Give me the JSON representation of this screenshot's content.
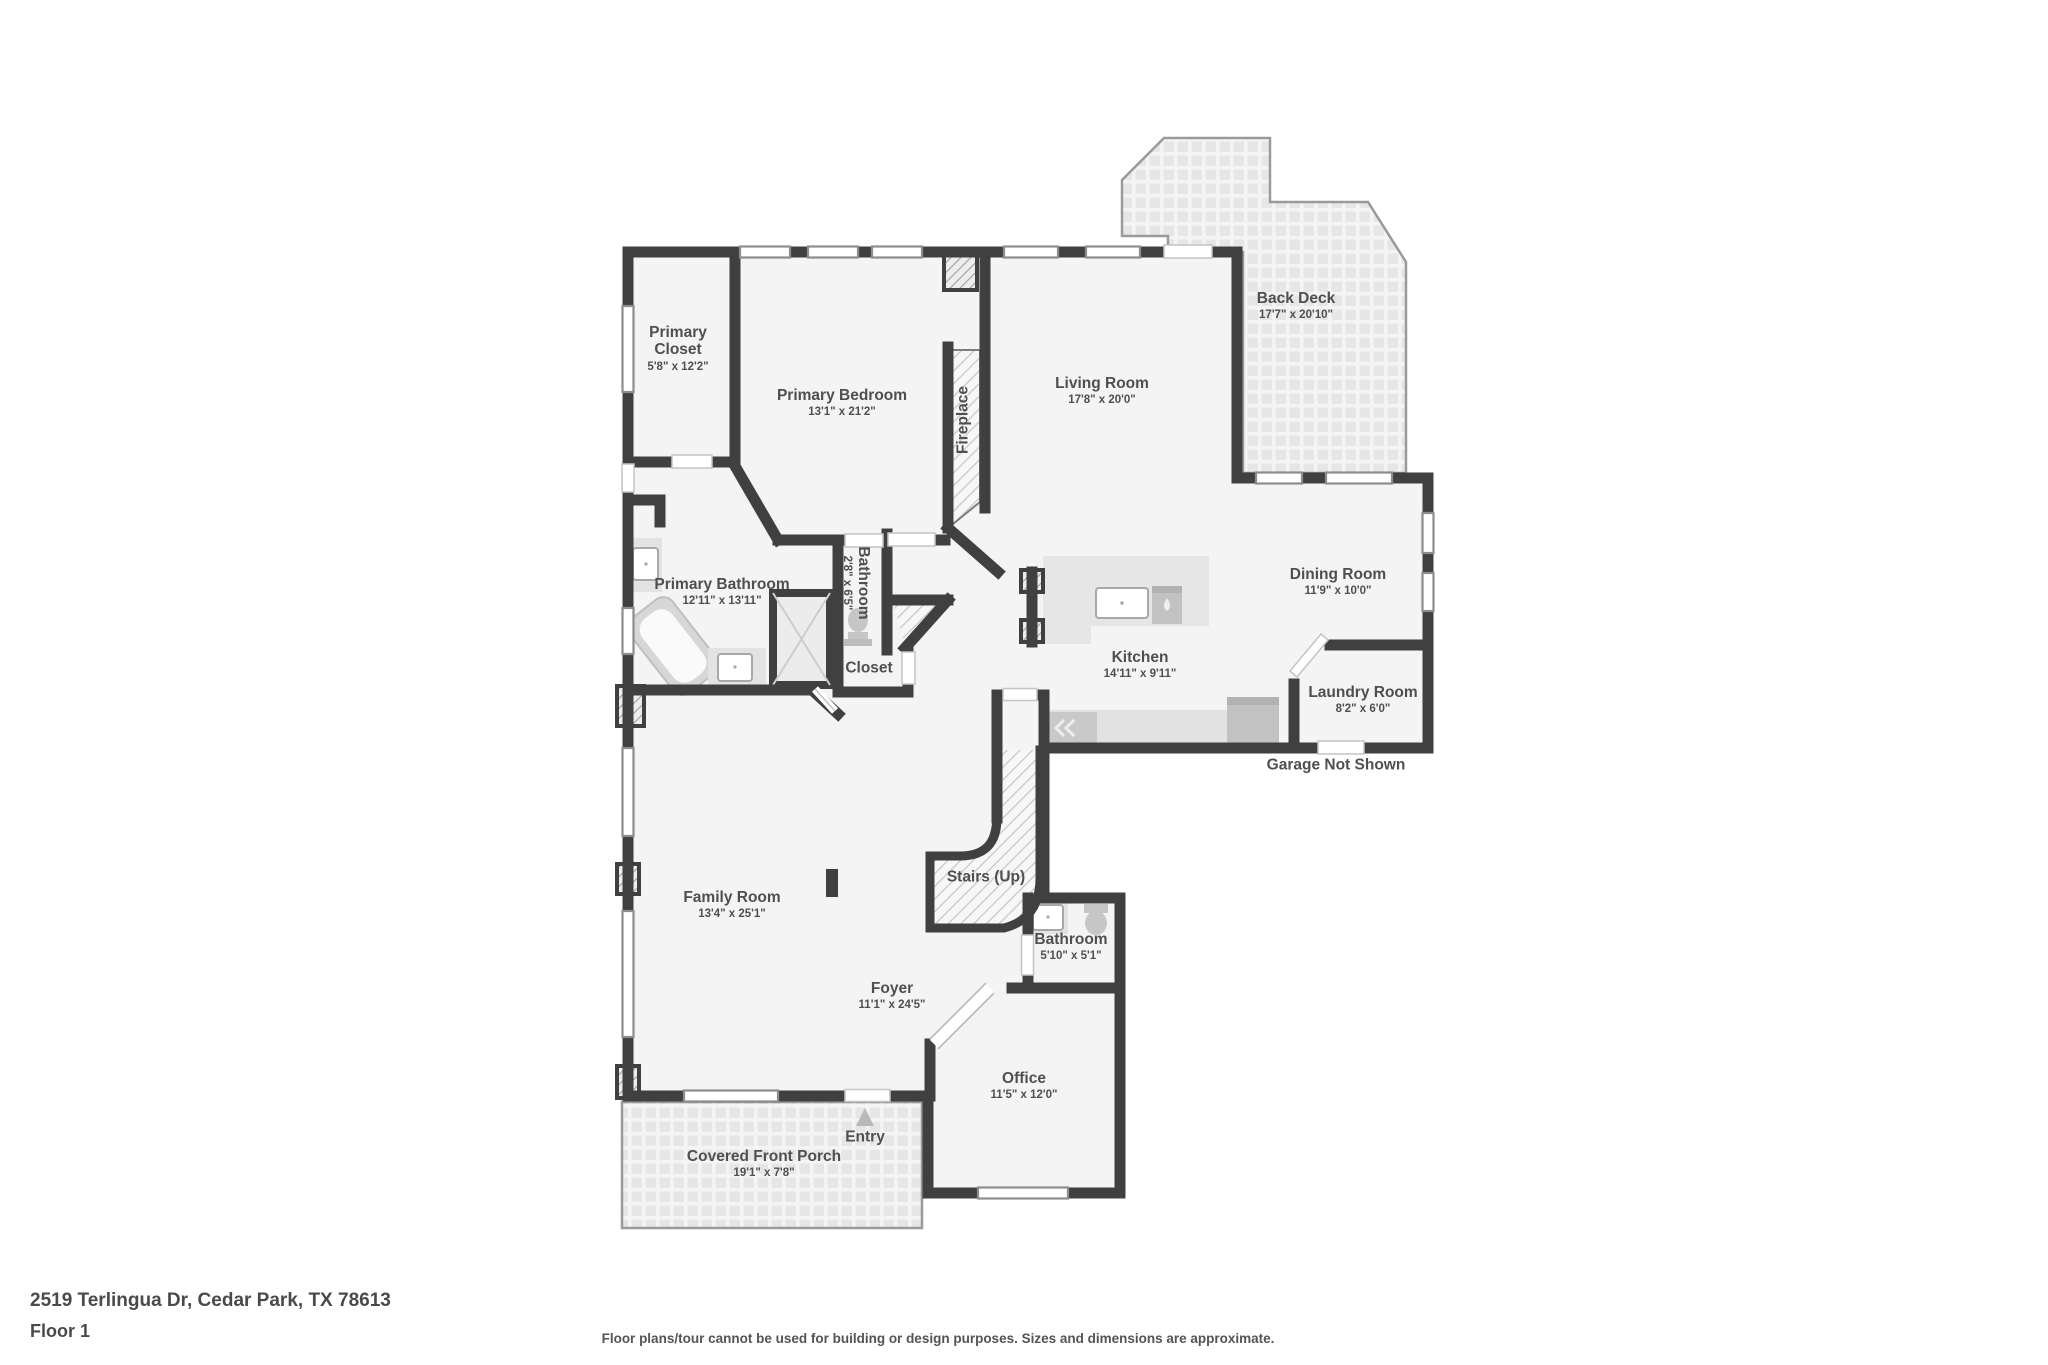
{
  "meta": {
    "address": "2519 Terlingua Dr, Cedar Park, TX 78613",
    "floor_label": "Floor 1",
    "disclaimer": "Floor plans/tour cannot be used for building or design purposes. Sizes and dimensions are approximate."
  },
  "colors": {
    "wall": "#404040",
    "room_fill": "#f4f4f4",
    "label_text": "#4f4f4f",
    "fixture": "#c6c6c6",
    "hatch_line": "#c9c9c9"
  },
  "icons": {
    "entry_arrow": "triangle-up",
    "stairs_surface": "diagonal-hatch",
    "deck_surface": "paver-grid",
    "porch_surface": "paver-grid"
  },
  "rooms": [
    {
      "id": "primary-closet",
      "name": "Primary Closet",
      "dims": "5'8\" x 12'2\""
    },
    {
      "id": "primary-bedroom",
      "name": "Primary Bedroom",
      "dims": "13'1\" x 21'2\""
    },
    {
      "id": "fireplace",
      "name": "Fireplace",
      "dims": ""
    },
    {
      "id": "living-room",
      "name": "Living Room",
      "dims": "17'8\" x 20'0\""
    },
    {
      "id": "back-deck",
      "name": "Back Deck",
      "dims": "17'7\" x 20'10\""
    },
    {
      "id": "primary-bathroom",
      "name": "Primary Bathroom",
      "dims": "12'11\" x 13'11\""
    },
    {
      "id": "bathroom-small",
      "name": "Bathroom",
      "dims": "2'8\" x 6'5\""
    },
    {
      "id": "closet",
      "name": "Closet",
      "dims": ""
    },
    {
      "id": "dining-room",
      "name": "Dining Room",
      "dims": "11'9\" x 10'0\""
    },
    {
      "id": "kitchen",
      "name": "Kitchen",
      "dims": "14'11\" x 9'11\""
    },
    {
      "id": "laundry-room",
      "name": "Laundry Room",
      "dims": "8'2\" x 6'0\""
    },
    {
      "id": "garage-note",
      "name": "Garage Not Shown",
      "dims": ""
    },
    {
      "id": "family-room",
      "name": "Family Room",
      "dims": "13'4\" x 25'1\""
    },
    {
      "id": "stairs",
      "name": "Stairs (Up)",
      "dims": ""
    },
    {
      "id": "bathroom",
      "name": "Bathroom",
      "dims": "5'10\" x 5'1\""
    },
    {
      "id": "foyer",
      "name": "Foyer",
      "dims": "11'1\" x 24'5\""
    },
    {
      "id": "office",
      "name": "Office",
      "dims": "11'5\" x 12'0\""
    },
    {
      "id": "entry",
      "name": "Entry",
      "dims": ""
    },
    {
      "id": "covered-front-porch",
      "name": "Covered Front Porch",
      "dims": "19'1\" x 7'8\""
    }
  ]
}
